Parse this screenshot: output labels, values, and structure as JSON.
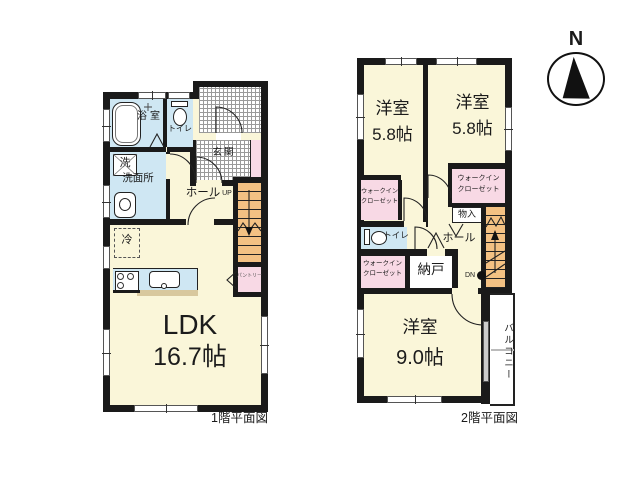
{
  "compass": {
    "label": "N"
  },
  "floor1": {
    "caption": "1階平面図",
    "ldk_label": "LDK",
    "ldk_size": "16.7帖",
    "bath": "浴室",
    "toilet": "トイレ",
    "washer": "洗",
    "washroom": "洗面所",
    "hall": "ホール",
    "up": "UP",
    "entrance": "玄関",
    "fridge": "冷",
    "pantry": "パントリー"
  },
  "floor2": {
    "caption": "2階平面図",
    "bedroom_a_label": "洋室",
    "bedroom_a_size": "5.8帖",
    "bedroom_b_label": "洋室",
    "bedroom_b_size": "5.8帖",
    "bedroom_c_label": "洋室",
    "bedroom_c_size": "9.0帖",
    "wic_line1": "ウォークイン",
    "wic_line2": "クローゼット",
    "toilet": "トイレ",
    "hall": "ホール",
    "storeroom": "納戸",
    "closet": "物入",
    "dn": "DN",
    "balcony": "バルコニー"
  },
  "colors": {
    "wall": "#1a1a1a",
    "room_yellow": "#faf6d9",
    "wet_blue": "#cfe7f3",
    "closet_pink": "#f8d9e5",
    "stairs_orange": "#f3c183",
    "counter_tan": "#d8c89e"
  }
}
